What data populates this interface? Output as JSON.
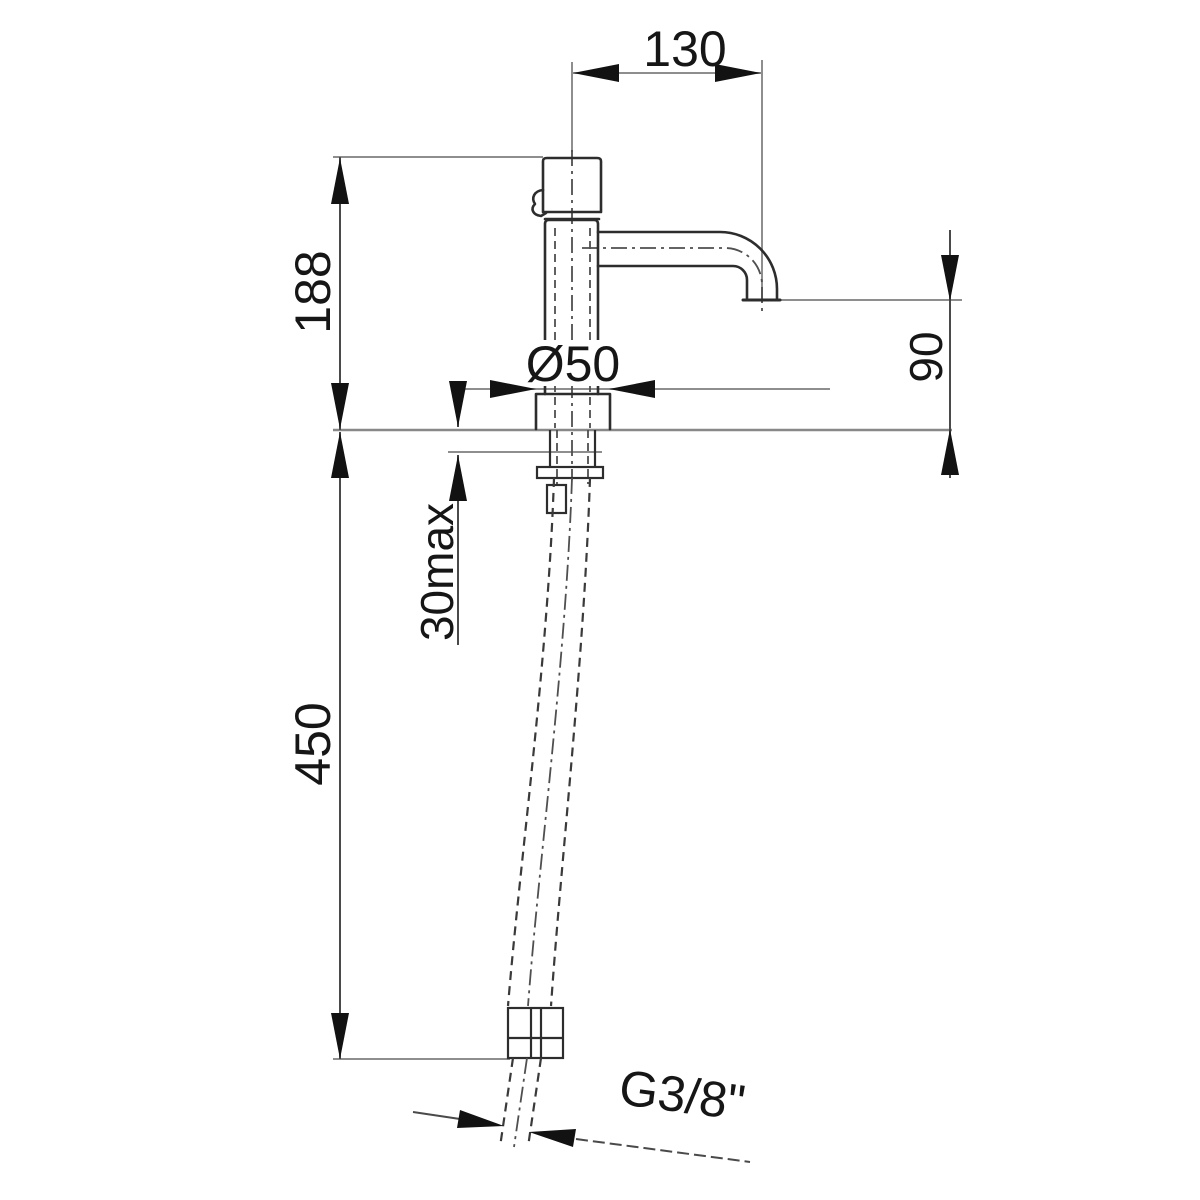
{
  "page": {
    "background": "#ffffff"
  },
  "drawing": {
    "subject": "Single-hole basin tap, side elevation with deck mounting and flexible supply hose",
    "units": "mm",
    "colors": {
      "outline": "#2d2d2d",
      "dimension_line": "#4a4a4a",
      "extension_line": "#8e8e8e",
      "arrow": "#121212",
      "text": "#161616",
      "background": "#ffffff"
    },
    "dimensions": {
      "spout_reach": {
        "label": "130",
        "orientation": "horizontal",
        "location": "top"
      },
      "body_height": {
        "label": "188",
        "orientation": "vertical",
        "location": "upper-left"
      },
      "base_diameter": {
        "label": "Ø50",
        "orientation": "horizontal",
        "location": "center"
      },
      "spout_height": {
        "label": "90",
        "orientation": "vertical",
        "location": "right"
      },
      "deck_thickness": {
        "label": "30max",
        "orientation": "vertical",
        "location": "center-left"
      },
      "hose_length": {
        "label": "450",
        "orientation": "vertical",
        "location": "lower-left"
      },
      "thread": {
        "label": "G3/8\"",
        "orientation": "angled",
        "location": "bottom"
      }
    }
  }
}
